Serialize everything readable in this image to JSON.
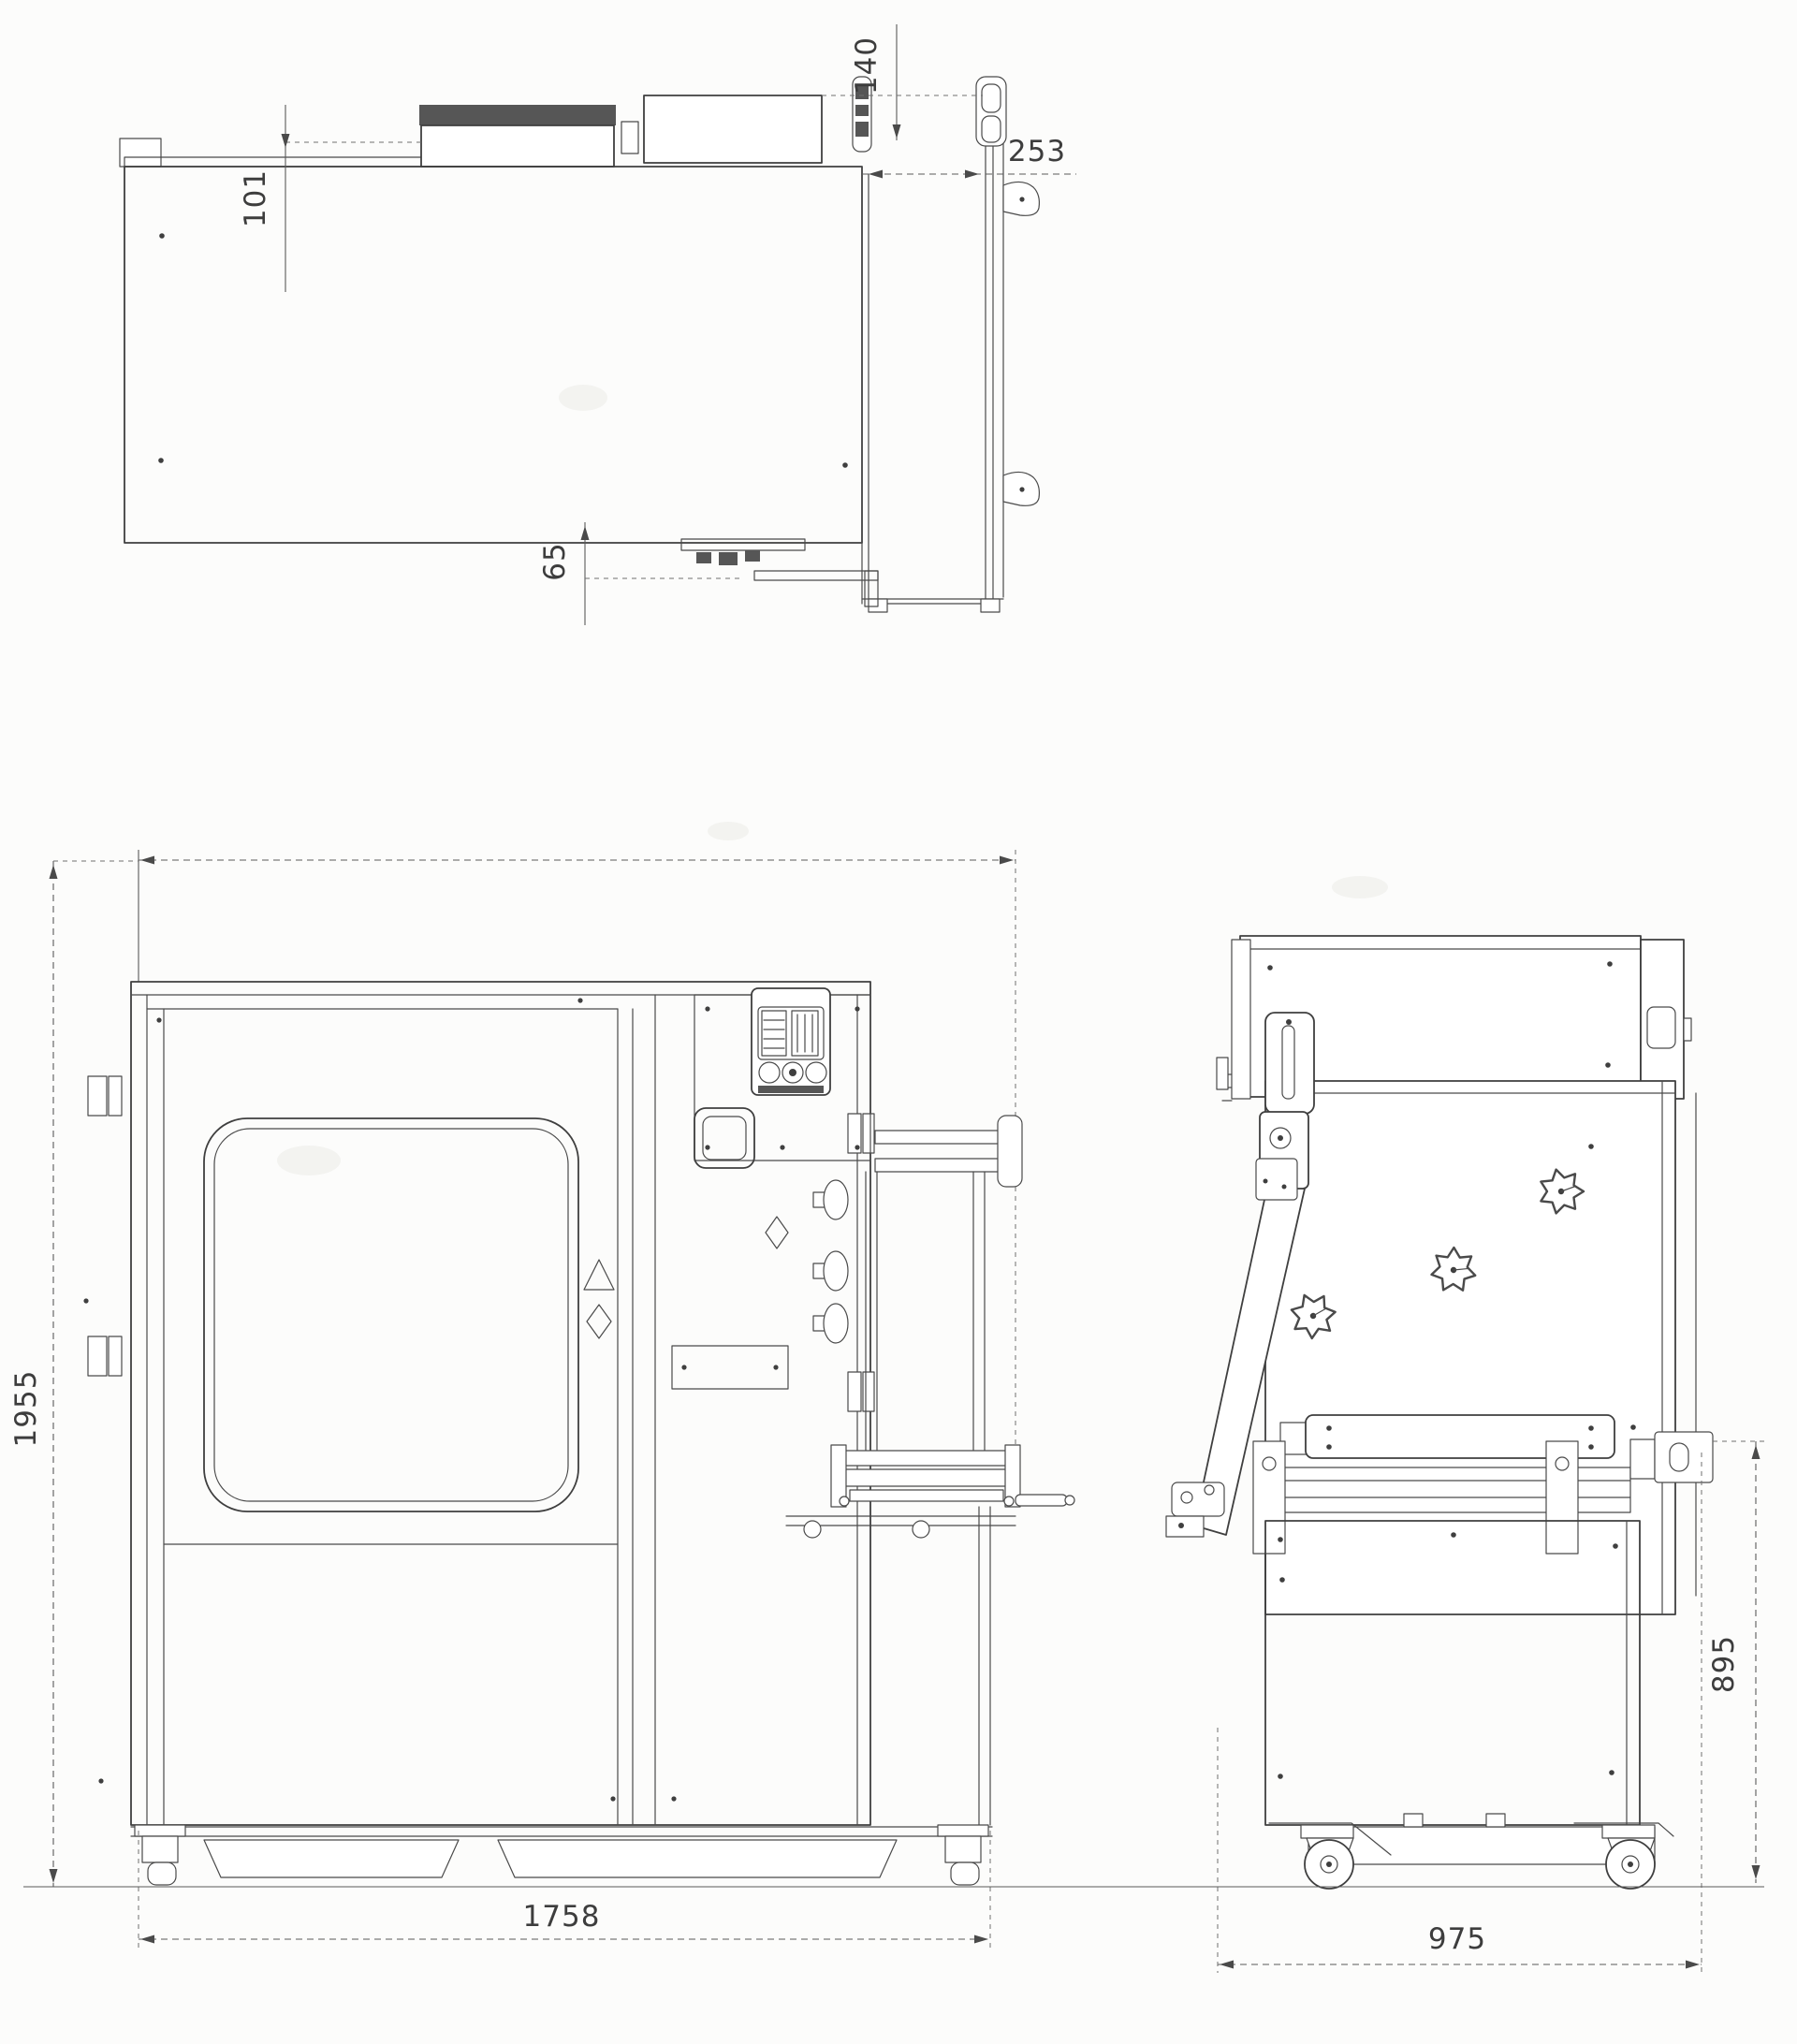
{
  "colors": {
    "line": "#3f3f3f",
    "dim_line": "#5a5a5a",
    "label": "#3d3d3d",
    "paper": "#fcfcfb",
    "dark_fill": "#565656"
  },
  "dimensions": {
    "top_view": {
      "hopper_projection": "101",
      "guide_rail_offset": "140",
      "discharge_extension_width": "253",
      "rear_mechanism_offset": "65"
    },
    "front_view": {
      "overall_height": "1955",
      "overall_width": "1758"
    },
    "side_view": {
      "table_height": "895",
      "overall_depth": "975"
    }
  }
}
